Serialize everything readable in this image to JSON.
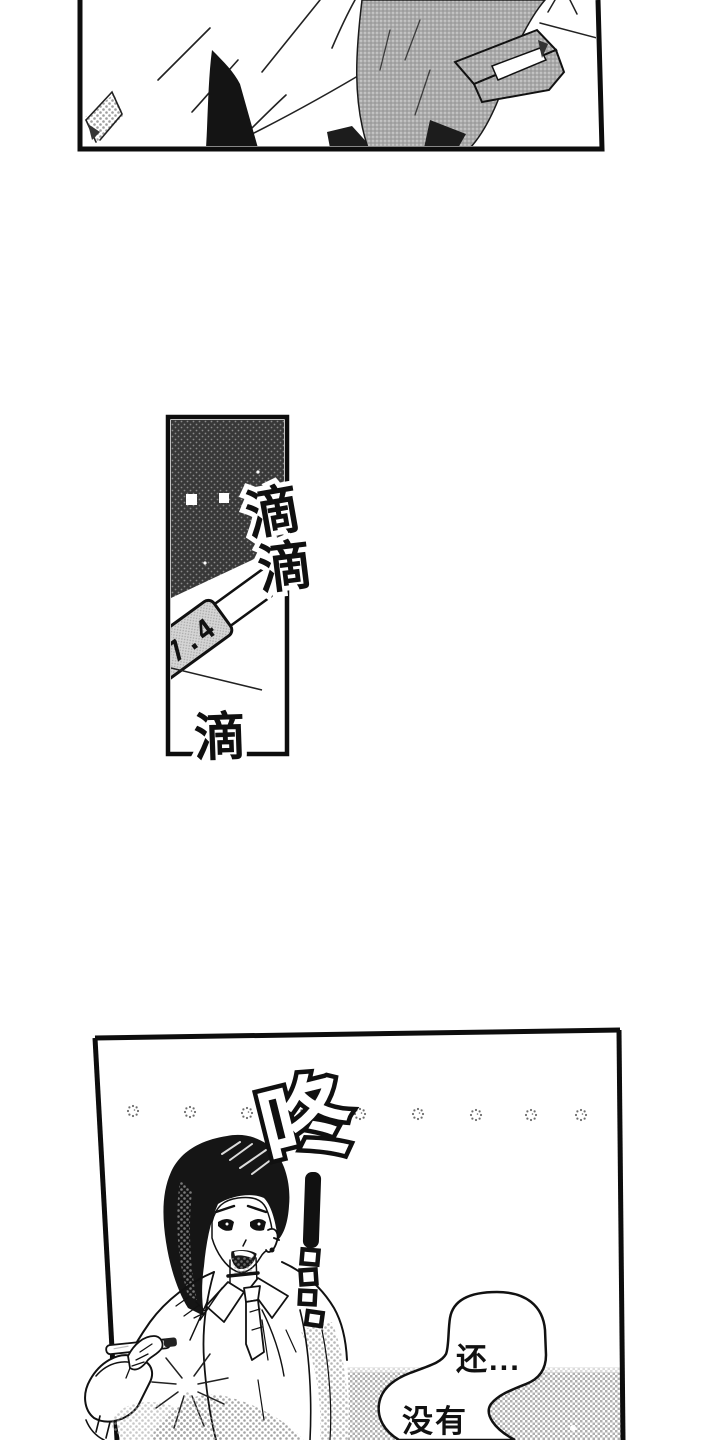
{
  "comic": {
    "sfx": {
      "drip1": "滴",
      "drip2": "滴",
      "drip3": "滴",
      "thud": "咚"
    },
    "thermometer": {
      "reading": "37.4"
    },
    "speech": {
      "line1": "还...",
      "line2": "没有"
    }
  },
  "colors": {
    "ink": "#111111",
    "paper": "#ffffff",
    "dark_screentone": "#3d3d3d",
    "light_screentone": "#b0b0b0"
  }
}
